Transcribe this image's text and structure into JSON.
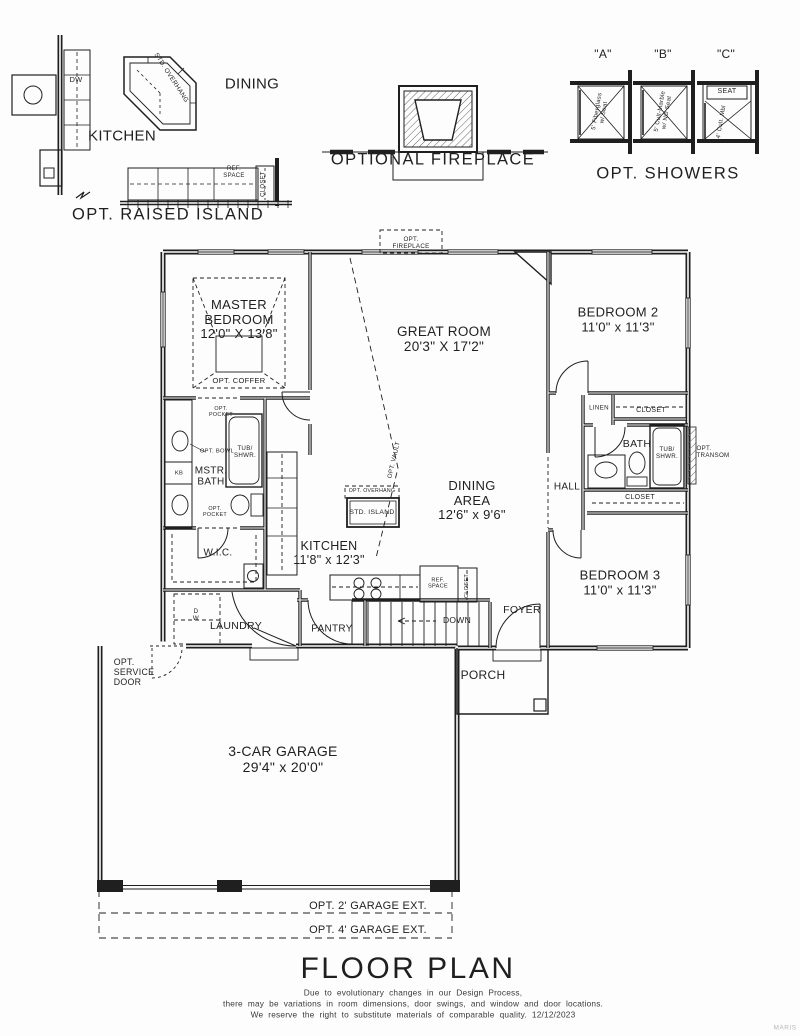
{
  "colors": {
    "ink": "#1f1f1f",
    "paper": "#fdfdfd",
    "muted": "#3a3a3a",
    "watermark": "#b7b7b7"
  },
  "insets": {
    "raised_island": {
      "caption": "OPT. RAISED ISLAND",
      "kitchen": "KITCHEN",
      "dining": "DINING",
      "dw": "DW",
      "std_overhang": "STD. OVERHANG",
      "ref_space": "REF.\nSPACE",
      "closet": "CLOSET"
    },
    "fireplace": {
      "caption": "OPTIONAL FIREPLACE"
    },
    "showers": {
      "caption": "OPT. SHOWERS",
      "a_tag": "\"A\"",
      "b_tag": "\"B\"",
      "c_tag": "\"C\"",
      "a_desc": "5' Fiberglass\nw/ Seat",
      "b_desc": "5' Cult-Marble\nw/ NO Seat",
      "c_seat": "SEAT",
      "c_desc": "4' Cult. Mbl"
    }
  },
  "rooms": {
    "master": "MASTER\nBEDROOM\n12'0\" X 13'8\"",
    "great": "GREAT ROOM\n20'3\" X 17'2\"",
    "bedroom2": "BEDROOM 2\n11'0\" x 11'3\"",
    "bedroom3": "BEDROOM 3\n11'0\" x 11'3\"",
    "dining": "DINING\nAREA\n12'6\" x 9'6\"",
    "kitchen": "KITCHEN\n11'8\" x 12'3\"",
    "garage": "3-CAR GARAGE\n29'4\" x 20'0\"",
    "mstr_bath": "MSTR.\nBATH",
    "bath": "BATH",
    "hall": "HALL",
    "foyer": "FOYER",
    "porch": "PORCH",
    "laundry": "LAUNDRY",
    "pantry": "PANTRY",
    "wic": "W.I.C."
  },
  "features": {
    "opt_fireplace": "OPT.\nFIREPLACE",
    "opt_coffer": "OPT. COFFER",
    "opt_vault": "OPT. VAULT",
    "opt_overhang": "OPT. OVERHANG",
    "std_island": "STD. ISLAND",
    "opt_pocket": "OPT.\nPOCKET",
    "opt_bowl": "OPT. BOWL",
    "kb": "KB",
    "tub_shwr": "TUB/\nSHWR.",
    "opt_transom": "OPT.\nTRANSOM",
    "linen": "LINEN",
    "closet": "CLOSET",
    "ref_space": "REF.\nSPACE",
    "down": "DOWN",
    "dw": "DW",
    "d_w": "D\nW",
    "opt_service_door": "OPT.\nSERVICE\nDOOR",
    "garage_ext_2": "OPT. 2' GARAGE EXT.",
    "garage_ext_4": "OPT. 4' GARAGE EXT."
  },
  "title_block": {
    "title": "FLOOR PLAN",
    "line1": "Due to evolutionary changes in our Design Process,",
    "line2": "there may be variations in room dimensions, door swings, and window and door locations.",
    "line3": "We reserve the right to substitute materials of comparable quality. 12/12/2023"
  },
  "watermark": "MARIS"
}
